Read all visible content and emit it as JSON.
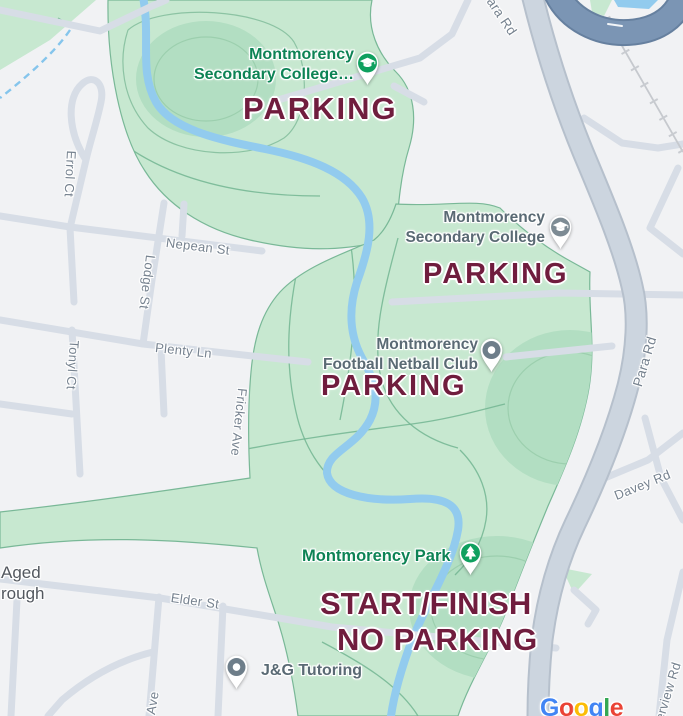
{
  "map_type": "google-maps-annotated-event-map",
  "colors": {
    "annotation_maroon": "#701d3e",
    "park_green": "#c7e8d0",
    "oval_green": "#b2dec2",
    "water_blue": "#92cbee",
    "poi_green": "#0d8355",
    "poi_slate": "#5a6a74",
    "street_label_gray": "#76828f",
    "road_fill": "#d7dde6",
    "major_road_fill": "#ccd5df",
    "overpass_blue": "#7b95b4"
  },
  "annotations": [
    {
      "id": "parking-top",
      "text": "PARKING"
    },
    {
      "id": "parking-college",
      "text": "PARKING"
    },
    {
      "id": "parking-netball",
      "text": "PARKING"
    },
    {
      "id": "start-finish",
      "text": "START/FINISH"
    },
    {
      "id": "no-parking",
      "text": "NO PARKING"
    }
  ],
  "pois": [
    {
      "id": "montmorency-secondary-college-north",
      "line1": "Montmorency",
      "line2": "Secondary College…",
      "icon": "graduation-cap",
      "pin_color": "#0fa05f",
      "label_style": "green"
    },
    {
      "id": "montmorency-secondary-college",
      "line1": "Montmorency",
      "line2": "Secondary College",
      "icon": "graduation-cap",
      "pin_color": "#7d8b94",
      "label_style": "slate"
    },
    {
      "id": "montmorency-football-netball-club",
      "line1": "Montmorency",
      "line2": "Football Netball Club",
      "icon": "dot",
      "pin_color": "#6e7e8a",
      "label_style": "slate"
    },
    {
      "id": "montmorency-park",
      "line1": "Montmorency Park",
      "icon": "tree",
      "pin_color": "#0fa05f",
      "label_style": "green"
    },
    {
      "id": "jg-tutoring",
      "line1": "J&G Tutoring",
      "icon": "dot",
      "pin_color": "#6e7e8a",
      "label_style": "slate"
    },
    {
      "id": "truncated-poi-left-edge",
      "line1": "Aged",
      "line2": "rough",
      "label_style": "dark"
    }
  ],
  "streets": [
    {
      "id": "para-rd-top",
      "name": "Para Rd"
    },
    {
      "id": "para-rd",
      "name": "Para Rd"
    },
    {
      "id": "nepean-st",
      "name": "Nepean St"
    },
    {
      "id": "errol-ct",
      "name": "Errol Ct"
    },
    {
      "id": "lodge-st",
      "name": "Lodge St"
    },
    {
      "id": "tonyl-ct",
      "name": "Tonyl Ct"
    },
    {
      "id": "plenty-ln",
      "name": "Plenty Ln"
    },
    {
      "id": "fricker-ave",
      "name": "Fricker Ave"
    },
    {
      "id": "elder-st",
      "name": "Elder St"
    },
    {
      "id": "davey-rd",
      "name": "Davey Rd"
    },
    {
      "id": "riverview-rd",
      "name": "Riverview Rd"
    },
    {
      "id": "ave-truncated",
      "name": "Ave"
    }
  ],
  "google_logo": [
    {
      "ch": "G",
      "style": "color:#4285F4"
    },
    {
      "ch": "o",
      "style": "color:#EA4335"
    },
    {
      "ch": "o",
      "style": "color:#FBBC05"
    },
    {
      "ch": "g",
      "style": "color:#4285F4"
    },
    {
      "ch": "l",
      "style": "color:#34A853"
    },
    {
      "ch": "e",
      "style": "color:#EA4335"
    }
  ]
}
